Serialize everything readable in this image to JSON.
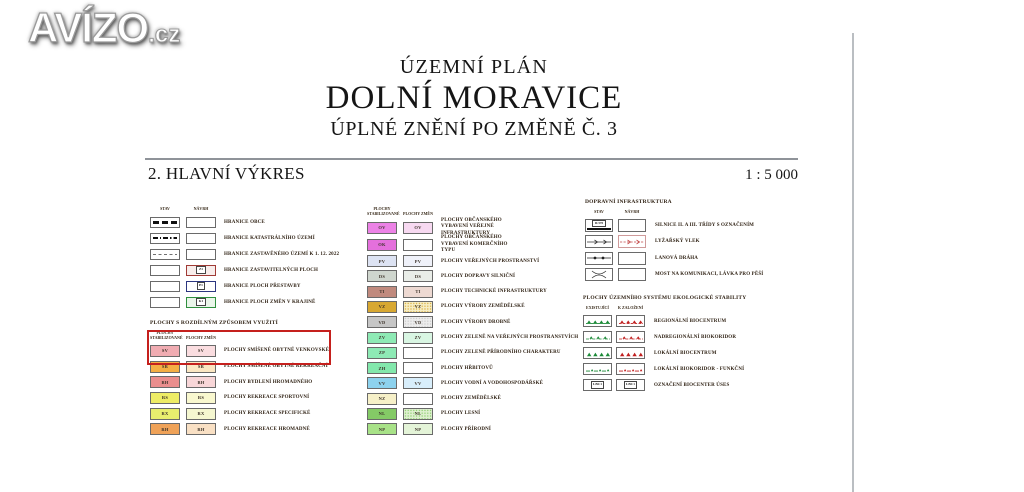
{
  "watermark": {
    "brand": "AVÍZO",
    "tld": ".cz"
  },
  "title": {
    "plan_type": "ÚZEMNÍ PLÁN",
    "municipality": "DOLNÍ MORAVICE",
    "amendment": "ÚPLNÉ ZNĚNÍ PO ZMĚNĚ Č. 3"
  },
  "drawing": {
    "name": "2. HLAVNÍ VÝKRES",
    "scale": "1 : 5 000"
  },
  "colors": {
    "highlight_box": "#c5201d",
    "rule": "#8f9399",
    "divider": "#babec2",
    "uses_existing": "#1c8a38",
    "uses_proposed": "#c01f1f"
  },
  "legend": {
    "boundaries": {
      "columns": [
        "STAV",
        "NÁVRH"
      ],
      "rows": [
        {
          "label": "HRANICE OBCE",
          "stav_pattern": "thick-dashes"
        },
        {
          "label": "HRANICE KATASTRÁLNÍHO ÚZEMÍ",
          "stav_pattern": "dash-dot"
        },
        {
          "label": "HRANICE ZASTAVĚNÉHO ÚZEMÍ K 1. 12. 2022",
          "stav_pattern": "dashes"
        },
        {
          "label": "HRANICE ZASTAVITELNÝCH PLOCH",
          "navrh_tag": "Z1",
          "navrh_border": "#a03a35",
          "navrh_fill": "#f8edeb"
        },
        {
          "label": "HRANICE PLOCH PŘESTAVBY",
          "navrh_tag": "P1",
          "navrh_border": "#2c3680",
          "navrh_fill": "#ffffff"
        },
        {
          "label": "HRANICE PLOCH ZMĚN V KRAJINĚ",
          "navrh_tag": "K1",
          "navrh_border": "#2f8f3e",
          "navrh_fill": "#eaf6ea"
        }
      ]
    },
    "use_areas": {
      "title": "PLOCHY S ROZDÍLNÝM ZPŮSOBEM VYUŽITÍ",
      "columns": [
        "PLOCHY STABILIZOVANÉ",
        "PLOCHY ZMĚN"
      ],
      "rows": [
        {
          "code": "SV",
          "stav_color": "#f0acb2",
          "zmen_color": "#fadde0",
          "label": "PLOCHY SMÍŠENÉ OBYTNÉ VENKOVSKÉ",
          "highlighted": true
        },
        {
          "code": "SR",
          "stav_color": "#f4ae44",
          "zmen_color": "#fbe7c2",
          "label": "PLOCHY SMÍŠENÉ OBYTNÉ REKREAČNÍ"
        },
        {
          "code": "BH",
          "stav_color": "#ea8e8e",
          "zmen_color": "#f8d6d8",
          "label": "PLOCHY BYDLENÍ HROMADNÉHO"
        },
        {
          "code": "RS",
          "stav_color": "#eeec66",
          "zmen_color": "#f9f8cf",
          "label": "PLOCHY REKREACE SPORTOVNÍ"
        },
        {
          "code": "RX",
          "stav_color": "#e8ee6e",
          "zmen_color": "#f5f7d0",
          "label": "PLOCHY REKREACE SPECIFICKÉ"
        },
        {
          "code": "RH",
          "stav_color": "#efa258",
          "zmen_color": "#f9e0c4",
          "label": "PLOCHY REKREACE HROMADNÉ"
        }
      ]
    },
    "function_areas": {
      "columns": [
        "PLOCHY STABILIZOVANÉ",
        "PLOCHY ZMĚN"
      ],
      "rows": [
        {
          "code": "OV",
          "stav_color": "#ec82e6",
          "zmen_color": "#f7d9f1",
          "label": "PLOCHY OBČANSKÉHO VYBAVENÍ VEŘEJNÉ INFRASTRUKTURY",
          "wrap": true
        },
        {
          "code": "OK",
          "stav_color": "#e470dc",
          "zmen_color": null,
          "label": "PLOCHY OBČANSKÉHO VYBAVENÍ KOMERČNÍHO TYPU",
          "wrap": true
        },
        {
          "code": "PV",
          "stav_color": "#dde3f3",
          "zmen_color": "#eff1f9",
          "label": "PLOCHY VEŘEJNÝCH PROSTRANSTVÍ"
        },
        {
          "code": "DS",
          "stav_color": "#cfd6ce",
          "zmen_color": "#e9ede8",
          "label": "PLOCHY DOPRAVY SILNIČNÍ"
        },
        {
          "code": "TI",
          "stav_color": "#c08a7e",
          "zmen_color": "#edd9d2",
          "label": "PLOCHY TECHNICKÉ INFRASTRUKTURY"
        },
        {
          "code": "VZ",
          "stav_color": "#d8a832",
          "zmen_color": "#f6eec6",
          "zmen_texture": "dots",
          "label": "PLOCHY VÝROBY ZEMĚDĚLSKÉ"
        },
        {
          "code": "VD",
          "stav_color": "#c6c6c6",
          "zmen_color": "#ededed",
          "zmen_texture": "dots",
          "label": "PLOCHY VÝROBY DROBNÉ"
        },
        {
          "code": "ZV",
          "stav_color": "#8eeab5",
          "zmen_color": "#d9f6e3",
          "label": "PLOCHY ZELENĚ NA VEŘEJNÝCH PROSTRANSTVÍCH"
        },
        {
          "code": "ZP",
          "stav_color": "#8eeab5",
          "zmen_color": null,
          "label": "PLOCHY ZELENĚ PŘÍRODNÍHO CHARAKTERU"
        },
        {
          "code": "ZH",
          "stav_color": "#83e8ac",
          "zmen_color": null,
          "label": "PLOCHY HŘBITOVŮ"
        },
        {
          "code": "VV",
          "stav_color": "#8dd2ee",
          "zmen_color": "#d8eefb",
          "label": "PLOCHY VODNÍ A VODOHOSPODÁŘSKÉ"
        },
        {
          "code": "NZ",
          "stav_color": "#f6f0c8",
          "zmen_color": null,
          "label": "PLOCHY ZEMĚDĚLSKÉ"
        },
        {
          "code": "NL",
          "stav_color": "#84ca66",
          "zmen_color": "#dff0d0",
          "zmen_texture": "dots",
          "label": "PLOCHY LESNÍ"
        },
        {
          "code": "NP",
          "stav_color": "#a8e288",
          "zmen_color": "#e4f4d8",
          "label": "PLOCHY PŘÍRODNÍ"
        }
      ]
    },
    "transport": {
      "title": "DOPRAVNÍ INFRASTRUKTURA",
      "columns": [
        "STAV",
        "NÁVRH"
      ],
      "rows": [
        {
          "label": "SILNICE II. A III. TŘÍDY S OZNAČENÍM",
          "symbol": "road",
          "road_label": "II/370"
        },
        {
          "label": "LYŽAŘSKÝ VLEK",
          "symbol": "lift",
          "has_navrh": true
        },
        {
          "label": "LANOVÁ DRÁHA",
          "symbol": "cable"
        },
        {
          "label": "MOST NA KOMUNIKACI, LÁVKA PRO PĚŠÍ",
          "symbol": "bridge"
        }
      ]
    },
    "uses": {
      "title": "PLOCHY ÚZEMNÍHO SYSTÉMU EKOLOGICKÉ STABILITY",
      "columns": [
        "EXISTUJÍCÍ",
        "K ZALOŽENÍ"
      ],
      "rows": [
        {
          "label": "REGIONÁLNÍ BIOCENTRUM",
          "symbol": "biocentrum-line"
        },
        {
          "label": "NADREGIONÁLNÍ BIOKORIDOR",
          "symbol": "biokoridor-dashdot"
        },
        {
          "label": "LOKÁLNÍ BIOCENTRUM",
          "symbol": "triangles"
        },
        {
          "label": "LOKÁLNÍ BIOKORIDOR - FUNKČNÍ",
          "symbol": "small-triangles"
        },
        {
          "label": "OZNAČENÍ BIOCENTER ÚSES",
          "symbol": "tag",
          "tag": "LBC1"
        }
      ]
    }
  }
}
